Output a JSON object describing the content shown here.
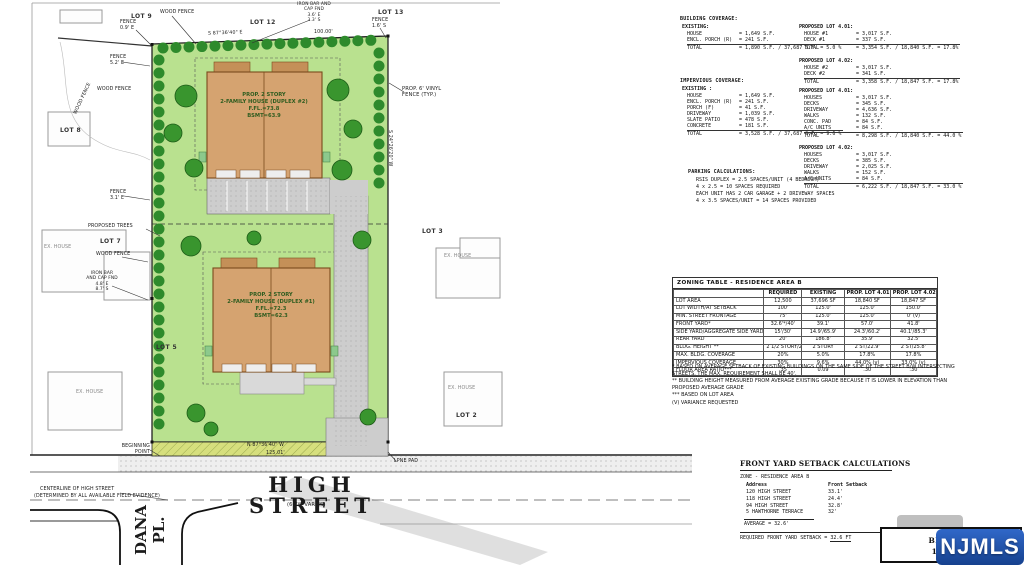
{
  "plan": {
    "streets": {
      "high_street": "HIGH STREET",
      "high_street_width": "(66'W VARIES)",
      "dana_pl": "DANA\nPL.",
      "centerline_1": "CENTERLINE OF HIGH STREET",
      "centerline_2": "(DETERMINED BY ALL AVAILABLE FIELD EVIDENCE)"
    },
    "houses": {
      "duplex2": "PROP. 2 STORY\n2-FAMILY HOUSE (DUPLEX #2)\nF.FL.=73.8\nBSMT=63.9",
      "duplex1": "PROP. 2 STORY\n2-FAMILY HOUSE (DUPLEX #1)\nF.FL.=72.3\nBSMT=62.3"
    },
    "lots": {
      "lot9": "LOT 9",
      "lot12": "LOT 12",
      "lot13": "LOT 13",
      "lot8": "LOT 8",
      "lot7": "LOT 7",
      "lot5": "LOT 5",
      "lot3": "LOT 3",
      "lot2": "LOT 2"
    },
    "annotations": {
      "wood_fence_top": "WOOD FENCE",
      "fence_09": "FENCE\n0.9' E",
      "iron_bar_top": "IRON BAR AND\nCAP FND\n3.6' E\n3.3' S",
      "bearing_top": "S 87°36'40\" E",
      "dim_100": "100.00'",
      "fence_16": "FENCE\n1.6' S",
      "wood_fence_left": "WOOD FENCE",
      "fence_52": "FENCE\n5.2' E",
      "wood_fence_left2": "WOOD FENCE",
      "fence_31": "FENCE\n3.1' E",
      "proposed_trees": "PROPOSED TREES",
      "wood_fence_mid": "WOOD FENCE",
      "iron_bar_mid": "IRON BAR\nAND CAP FND\n4.8' E\n8.7' S",
      "vinyl_fence": "PROP. 6' VINYL\nFENCE (TYP.)",
      "bearing_right": "S 24°26'20\" W",
      "bearing_bottom": "N 87°36'40\" W",
      "dim_bottom": "125.01'",
      "ex_house": "EX. HOUSE",
      "lpne_pad": "LPNE PAD",
      "beginning_point": "BEGINNING\nPOINT"
    }
  },
  "coverage": {
    "building": {
      "title": "BUILDING COVERAGE:",
      "existing_title": "EXISTING:",
      "existing_rows": [
        [
          "HOUSE",
          "= 1,649 S.F."
        ],
        [
          "ENCL. PORCH (R)",
          "= 241 S.F."
        ]
      ],
      "existing_total": [
        [
          "TOTAL",
          "= 1,890 S.F. / 37,687 S.F. = 5.0 %"
        ]
      ],
      "lot401_title": "PROPOSED LOT 4.01:",
      "lot401_rows": [
        [
          "HOUSE #1",
          "= 3,017 S.F."
        ],
        [
          "DECK #1",
          "= 337 S.F."
        ]
      ],
      "lot401_total": [
        [
          "TOTAL",
          "= 3,354 S.F. / 18,840 S.F. = 17.8%"
        ]
      ],
      "lot402_title": "PROPOSED LOT 4.02:",
      "lot402_rows": [
        [
          "HOUSE #2",
          "= 3,017 S.F."
        ],
        [
          "DECK #2",
          "= 341 S.F."
        ]
      ],
      "lot402_total": [
        [
          "TOTAL",
          "= 3,358 S.F. / 18,847 S.F. = 17.8%"
        ]
      ]
    },
    "impervious": {
      "title": "IMPERVIOUS COVERAGE:",
      "existing_title": "EXISTING :",
      "existing_rows": [
        [
          "HOUSE",
          "= 1,649 S.F."
        ],
        [
          "ENCL. PORCH (R)",
          "= 241 S.F."
        ],
        [
          "PORCH (F)",
          "= 41 S.F."
        ],
        [
          "DRIVEWAY",
          "= 1,039 S.F."
        ],
        [
          "SLATE PATIO",
          "= 478 S.F."
        ],
        [
          "CONCRETE",
          "= 181 S.F."
        ]
      ],
      "existing_total": [
        [
          "TOTAL",
          "= 3,528 S.F. / 37,687 S.F. = 9.6 %"
        ]
      ],
      "lot401_title": "PROPOSED LOT 4.01:",
      "lot401_rows": [
        [
          "HOUSES",
          "= 3,017 S.F."
        ],
        [
          "DECKS",
          "= 345 S.F."
        ],
        [
          "DRIVEWAY",
          "= 4,636 S.F."
        ],
        [
          "WALKS",
          "= 132 S.F."
        ],
        [
          "CONC. PAD",
          "= 84 S.F."
        ],
        [
          "A/C UNITS",
          "= 84 S.F."
        ]
      ],
      "lot401_total": [
        [
          "TOTAL",
          "= 8,298 S.F. / 18,840 S.F. = 44.0 %"
        ]
      ],
      "lot402_title": "PROPOSED LOT 4.02:",
      "lot402_rows": [
        [
          "HOUSES",
          "= 3,017 S.F."
        ],
        [
          "DECKS",
          "= 385 S.F."
        ],
        [
          "DRIVEWAY",
          "= 2,025 S.F."
        ],
        [
          "WALKS",
          "= 152 S.F."
        ],
        [
          "A/C UNITS",
          "= 84 S.F."
        ]
      ],
      "lot402_total": [
        [
          "TOTAL",
          "= 6,222 S.F. / 18,847 S.F. = 33.0 %"
        ]
      ]
    },
    "parking": {
      "title": "PARKING CALCULATIONS:",
      "lines": [
        "RSIS DUPLEX = 2.5 SPACES/UNIT (4 BEDROOM)",
        "4 x 2.5 = 10 SPACES REQUIRED",
        "EACH UNIT HAS 2 CAR GARAGE + 2 DRIVEWAY SPACES",
        "4 x 3.5 SPACES/UNIT = 14 SPACES PROVIDED"
      ]
    }
  },
  "zoning_table": {
    "title": "ZONING TABLE - RESIDENCE AREA B",
    "header_row": [
      [
        "",
        "REQUIRED",
        "EXISTING",
        "PROP. LOT 4.01",
        "PROP. LOT 4.02"
      ]
    ],
    "rows": [
      [
        "LOT AREA",
        "12,500",
        "37,696 SF",
        "18,840 SF",
        "18,847 SF"
      ],
      [
        "LOT WIDTH/AT SETBACK",
        "100'",
        "125.0'",
        "125.0'",
        "150.0'"
      ],
      [
        "MIN. STREET FRONTAGE",
        "75'",
        "125.0'",
        "125.0'",
        "0' (v)"
      ],
      [
        "FRONT YARD*",
        "32.6'*/40'",
        "39.1'",
        "57.0'",
        "41.8'"
      ],
      [
        "SIDE YARD/AGGREGATE SIDE YARD",
        "15'/30'",
        "14.9'/65.9'",
        "24.3'/60.2'",
        "40.1'/85.3'"
      ],
      [
        "REAR YARD",
        "20'",
        "186.8'",
        "35.9'",
        "32.5'"
      ],
      [
        "BLDG. HEIGHT **",
        "2 1/2 STORY/28'",
        "2 STORY",
        "2 ST/22.9'",
        "2 ST/25.8'"
      ],
      [
        "MAX. BLDG. COVERAGE",
        "20%",
        "5.0%",
        "17.8%",
        "17.8%"
      ],
      [
        "IMPERVIOUS COVERAGE",
        "30%",
        "9.6%",
        "44.0% (v)",
        "33.0% (v)"
      ],
      [
        "FLOOR AREA RATIO***",
        ".35",
        "0.09",
        ".30",
        ".30"
      ]
    ],
    "notes": [
      "* BASED ON AVERAGE SETBACK OF EXISTING BUILDINGS ON THE SAME SIDE OF THE STREET B/W INTERSECTING STREETS. THE MAX. REQUIREMENT SHALL BE 40'.",
      "** BUILDING HEIGHT MEASURED FROM AVERAGE EXISTING GRADE BECAUSE IT IS LOWER IN ELEVATION THAN PROPOSED AVERAGE GRADE",
      "*** BASED ON LOT AREA",
      "(V) VARIANCE REQUESTED"
    ]
  },
  "setback_calc": {
    "title": "FRONT YARD SETBACK CALCULATIONS",
    "zone": "ZONE - RESIDENCE AREA B",
    "header_row": [
      [
        "Address",
        "Front Setback"
      ]
    ],
    "rows": [
      [
        "120 HIGH STREET",
        "33.1'"
      ],
      [
        "118 HIGH STREET",
        "24.4'"
      ],
      [
        "94 HIGH STREET",
        "32.8'"
      ],
      [
        "5 HAWTHORNE TERRACE",
        "32'"
      ]
    ],
    "average": "AVERAGE = 32.6'",
    "required_label": "REQUIRED FRONT YARD SETBACK = ",
    "required_value": "32.6 FT"
  },
  "title_block": {
    "line1": "BLOCK 3.",
    "line2": "104 HIG"
  },
  "watermark": "NJMLS",
  "colors": {
    "lawn": "#b9e18f",
    "shrub": "#2e8a2c",
    "house": "#d5a370",
    "pavement": "#cdcdcd",
    "njmls_blue": "#1d4f9e"
  }
}
